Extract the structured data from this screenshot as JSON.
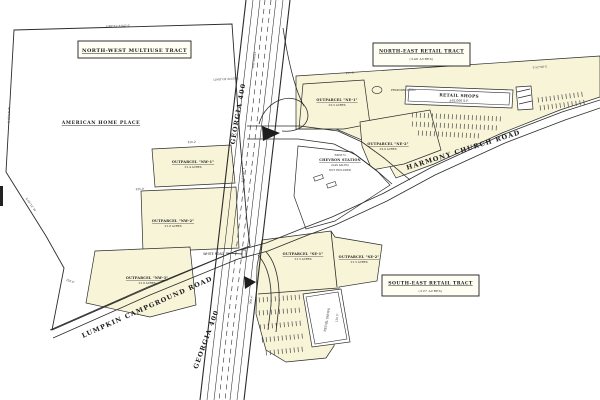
{
  "plan": {
    "tracts": {
      "northwest": {
        "title": "NORTH-WEST MULTIUSE TRACT"
      },
      "northeast": {
        "title": "NORTH-EAST RETAIL TRACT",
        "acres": "(±48 ACRES)"
      },
      "southeast": {
        "title": "SOUTH-EAST RETAIL TRACT",
        "acres": "(±27 ACRES)"
      }
    },
    "outparcels": {
      "nw1": {
        "label": "OUTPARCEL \"NW-1\"",
        "acres": "±1.4 ACRES"
      },
      "nw2": {
        "label": "OUTPARCEL \"NW-2\"",
        "acres": "±1.8 ACRES"
      },
      "nw3": {
        "label": "OUTPARCEL \"NW-3\"",
        "acres": "±1.6 ACRES"
      },
      "ne1": {
        "label": "OUTPARCEL \"NE-1\"",
        "acres": "±2.5 ACRES"
      },
      "ne2": {
        "label": "OUTPARCEL \"NE-2\"",
        "acres": "±2.0 ACRES"
      },
      "se1": {
        "label": "OUTPARCEL \"SE-1\"",
        "acres": "±1.5 ACRES"
      },
      "se2": {
        "label": "OUTPARCEL \"SE-2\"",
        "acres": "±1.5 ACRES"
      }
    },
    "roads": {
      "georgia400": "GEORGIA 400",
      "harmony": "HARMONY CHURCH ROAD",
      "lumpkin": "LUMPKIN CAMPGROUND ROAD",
      "white": "WHITE ROAD"
    },
    "buildings": {
      "ne_retail": {
        "name": "RETAIL SHOPS",
        "size": "±62,000 S.F."
      },
      "se_retail": {
        "name": "RETAIL SHOPS"
      },
      "chevron": {
        "line1": "EXIST'G",
        "line2": "CHEVRON STATION",
        "line3": "(GAS SALES)",
        "line4": "NOT INCLUDED"
      }
    },
    "annotations": {
      "american_home": "AMERICAN HOME PLACE",
      "proposed_pond": "PROPOSED POND",
      "limit_of_access": "LIMIT OF ACCESS"
    },
    "dimensions": [
      "N 02°18' W",
      "S 88°21' E  642.0'",
      "310.2'",
      "N 01°40' E",
      "225.0'",
      "S 46°12' W",
      "150.0'",
      "R/W VARIES",
      "417.3'",
      "S 52°08' E",
      "308.4'",
      "120.0'"
    ],
    "colors": {
      "parcel_fill": "#f7f4d8",
      "line": "#2b2b2b",
      "paper": "#ffffff"
    }
  }
}
